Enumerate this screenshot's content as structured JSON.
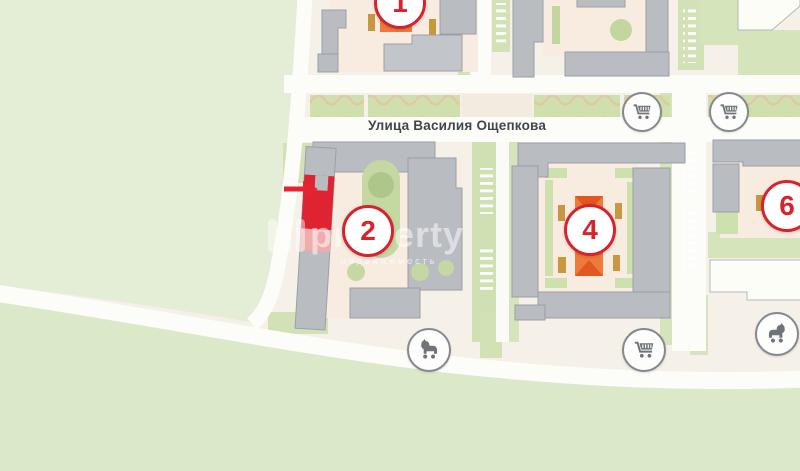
{
  "map": {
    "street": {
      "label": "Улица Василия Ощепкова"
    },
    "watermark": {
      "brand": "property",
      "tagline": "недвижимость"
    },
    "buildings": [
      {
        "number": "1"
      },
      {
        "number": "2"
      },
      {
        "number": "4"
      },
      {
        "number": "6"
      }
    ],
    "markers": {
      "shop": "shopping-cart-icon",
      "playground": "toy-horse-icon"
    },
    "colors": {
      "field_green_north": "#e4edd6",
      "field_green_south": "#dce9c8",
      "block_ground": "#f5f1e9",
      "courtyard_cream": "#f8ece1",
      "building_gray": "#b9bdc2",
      "building_outline": "#9aa0a6",
      "lawn_green": "#cfe0b2",
      "lawn_green_dark": "#aec689",
      "road_white": "#fcfcf9",
      "boulevard_wave_tan": "#e0c9a2",
      "playground_tan": "#c8973f",
      "orange_structure": "#ee7a3b",
      "orange_roof": "#e0571f",
      "marker_red": "#d6232e",
      "highlight_red": "#e02330",
      "highlight_red_light": "#f0abad",
      "icon_gray": "#6f7479",
      "street_text": "#41464c"
    }
  }
}
